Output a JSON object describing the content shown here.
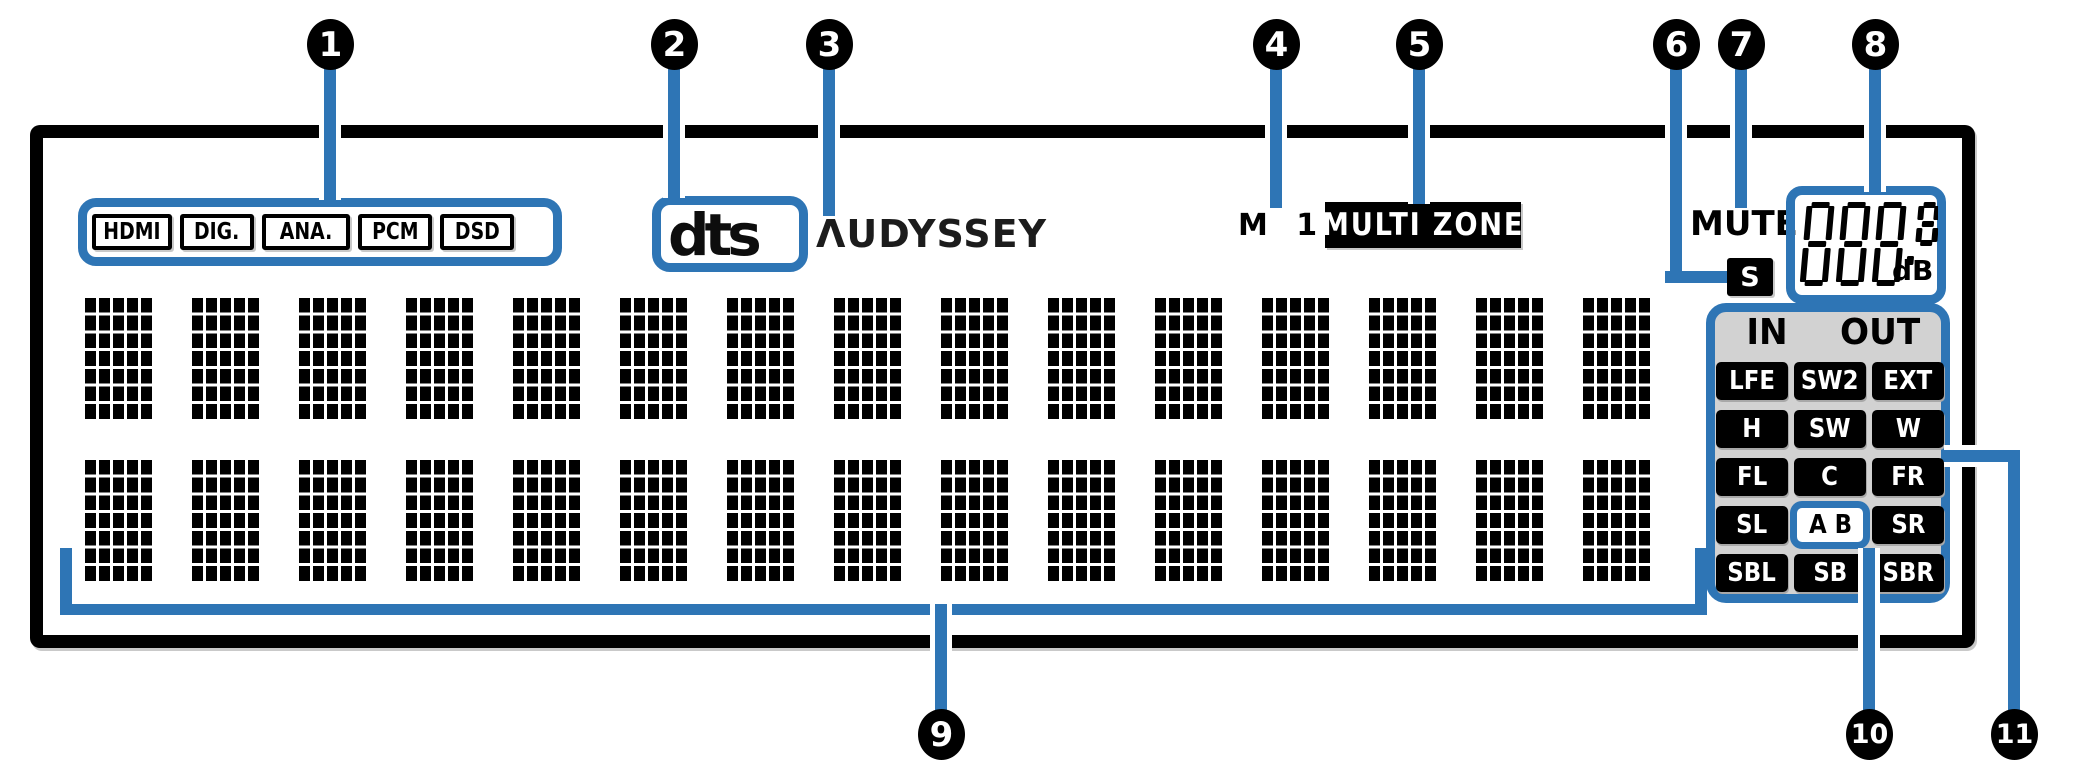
{
  "diagram": {
    "title": "AV receiver front display indicator diagram",
    "callout_numbers": [
      "1",
      "2",
      "3",
      "4",
      "5",
      "6",
      "7",
      "8",
      "9",
      "10",
      "11"
    ]
  },
  "display": {
    "input_indicators": [
      "HDMI",
      "DIG.",
      "ANA.",
      "PCM",
      "DSD"
    ],
    "decoder_logo": "dts",
    "audyssey_logo": "ΛUDYSSEY",
    "monitor_out_indicator": "M 1 2",
    "multi_zone_label": "MULTI ZONE",
    "mute_label": "MUTE",
    "sleep_timer_indicator": "S",
    "volume_display": {
      "digits": "888",
      "small_digit": "8",
      "decimal_point": true,
      "unit": "dB",
      "style": "all-segments-lit"
    },
    "io_labels": {
      "in": "IN",
      "out": "OUT"
    },
    "channel_indicators": {
      "rows": [
        [
          "LFE",
          "SW2",
          "EXT"
        ],
        [
          "H",
          "SW",
          "W"
        ],
        [
          "FL",
          "C",
          "FR"
        ],
        [
          "SL",
          "A B",
          "SR"
        ],
        [
          "SBL",
          "SB",
          "SBR"
        ]
      ],
      "highlighted": "A B"
    },
    "dot_matrix": {
      "rows": 2,
      "columns": 15,
      "dots_per_char": "5x7"
    }
  },
  "colors": {
    "accent_blue": "#2E75B5",
    "panel_border": "#000000",
    "channel_block_bg": "#D2D2D2",
    "indicator_text": "#000000"
  }
}
